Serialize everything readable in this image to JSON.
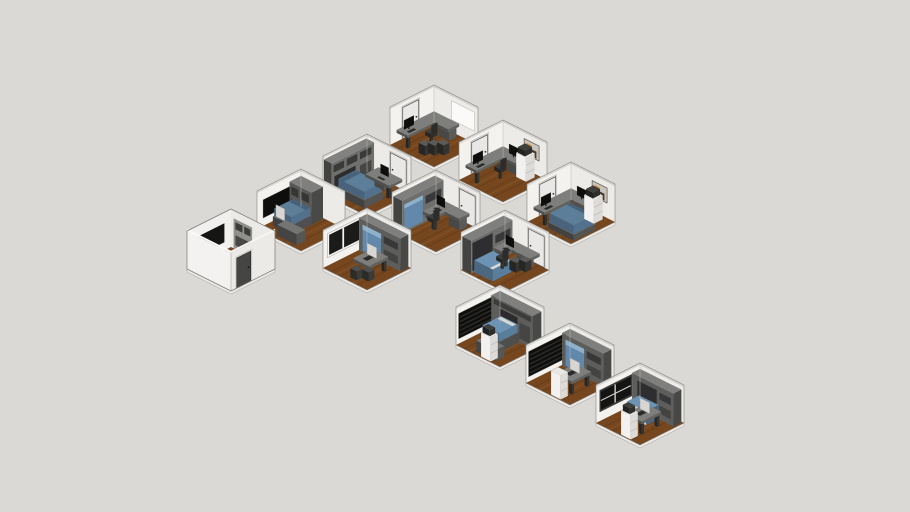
{
  "scene": {
    "width": 910,
    "height": 512,
    "background": "#dad9d5",
    "description": "Isometric dollhouse view of twelve furnished micro-room modules (beds, murphy beds, desks, wardrobes, TVs) arranged in a staggered diagonal grid on a plain grey backdrop"
  },
  "palette": {
    "background": "#dad9d5",
    "wall_light": "#f3f2ef",
    "wall_dark": "#ecebe8",
    "slab": "#eceae7",
    "floor": "#76471f",
    "floor_dark": "#5b3513",
    "floor_light": "#8f5c2c",
    "furniture_grey": "#7f7f7d",
    "screen": "#0e0e0c",
    "door": "#e9e8e6",
    "door_frame": "#4a4a48",
    "bed_blue": "#5d7e99",
    "murphy": "#6289ac",
    "murphy_hi": "#8fb0ca",
    "cabinet_white": "#f2f1ef",
    "art_paper": "#cac5bc",
    "art_orange": "#d4943f",
    "art_dark": "#4a3a2c",
    "art_frame": "#57524b"
  },
  "rooms": [
    {
      "name": "office-1",
      "label": "corner office with door and whiteboard",
      "x": 390,
      "y": 85,
      "variant": "interior",
      "items": [
        "door-left",
        "whiteboard-right",
        "corner-desk",
        "monitor-left",
        "office-chair",
        "drawer-cubes"
      ]
    },
    {
      "name": "office-2",
      "label": "office with wall art and dual monitors",
      "x": 459,
      "y": 120,
      "variant": "interior",
      "items": [
        "door-left",
        "art-right",
        "corner-desk",
        "monitor-left",
        "monitor-right",
        "office-chair",
        "file-cabinet-right"
      ]
    },
    {
      "name": "bedroom-1",
      "label": "bedroom with wall unit, bed and desk",
      "x": 323,
      "y": 134,
      "variant": "interior",
      "items": [
        "wall-unit-left",
        "door-right",
        "bed-left",
        "desk-right",
        "monitor-desk-right"
      ]
    },
    {
      "name": "bedroom-office",
      "label": "bedroom office with bed and dual monitors",
      "x": 527,
      "y": 162,
      "variant": "interior",
      "items": [
        "door-left",
        "art-right",
        "corner-desk",
        "monitor-left",
        "monitor-right",
        "bed-flat",
        "file-cabinet-right"
      ]
    },
    {
      "name": "bedroom-tv",
      "label": "bedroom with wall tv and bed",
      "x": 257,
      "y": 169,
      "variant": "interior",
      "items": [
        "tv-left",
        "wall-unit-right",
        "bed-right",
        "monitor-white-bed",
        "bench-front"
      ]
    },
    {
      "name": "murphy-office-1",
      "label": "murphy-bed office",
      "x": 392,
      "y": 170,
      "variant": "interior",
      "items": [
        "murphy-closed-left",
        "door-right",
        "desk-mid",
        "monitor-corner",
        "office-chair"
      ]
    },
    {
      "name": "studio-1",
      "label": "studio with window and murphy bed",
      "x": 323,
      "y": 208,
      "variant": "interior",
      "items": [
        "window-left",
        "murphy-closed-right",
        "desk-front",
        "monitor-white",
        "ottomans"
      ]
    },
    {
      "name": "shell",
      "label": "closed room shell seen from outside",
      "x": 187,
      "y": 209,
      "variant": "exterior",
      "items": [
        "front-door",
        "interior-tv",
        "interior-cabinet"
      ]
    },
    {
      "name": "murphy-office-2",
      "label": "murphy-bed office with open bed",
      "x": 461,
      "y": 210,
      "variant": "interior",
      "items": [
        "murphy-open-left",
        "door-right",
        "corner-desk-right",
        "monitor-corner",
        "office-chair",
        "drawer-cubes-right"
      ]
    },
    {
      "name": "media-bedroom",
      "label": "bedroom with media wall and open bed",
      "x": 456,
      "y": 285,
      "variant": "interior",
      "items": [
        "big-screen-left",
        "bridge-unit-right",
        "bed-open-center",
        "bench-front",
        "cabinet-left-printer"
      ]
    },
    {
      "name": "studio-2",
      "label": "studio with media wall and murphy bed",
      "x": 526,
      "y": 323,
      "variant": "interior",
      "items": [
        "big-screen-left",
        "murphy-closed-right",
        "desk-front",
        "monitor-white",
        "cabinet-left"
      ]
    },
    {
      "name": "studio-3",
      "label": "studio with window and fold-down bed",
      "x": 596,
      "y": 363,
      "variant": "interior",
      "items": [
        "window-dark-left",
        "murphy-open-right",
        "desk-front",
        "monitor-white",
        "cabinet-left-printer"
      ]
    }
  ]
}
